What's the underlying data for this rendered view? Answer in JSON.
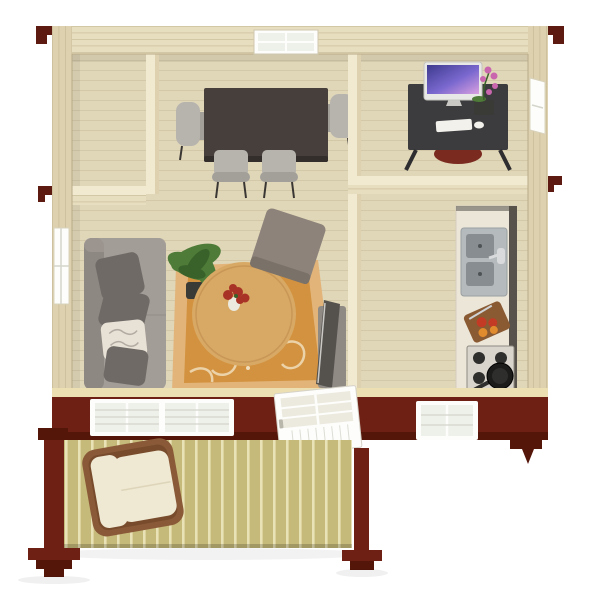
{
  "scene": {
    "description": "isometric-3d-floorplan-render-of-log-cabin",
    "background": "#ffffff",
    "rooms": [
      {
        "name": "entry-room",
        "contents": []
      },
      {
        "name": "dining-room",
        "contents": [
          "dark-dining-table",
          "four-gray-chairs",
          "window"
        ]
      },
      {
        "name": "office",
        "contents": [
          "dark-desk",
          "imac-monitor",
          "keyboard",
          "mouse",
          "orchid-plant",
          "red-chair",
          "side-window"
        ]
      },
      {
        "name": "living-room",
        "contents": [
          "gray-sofa",
          "pillows",
          "potted-plant",
          "round-coffee-table",
          "flower-vase",
          "floral-rug",
          "ottoman",
          "tv"
        ]
      },
      {
        "name": "kitchen",
        "contents": [
          "counter",
          "double-sink",
          "cutting-board-with-fruit",
          "gas-stove",
          "frying-pan"
        ]
      },
      {
        "name": "front-porch",
        "contents": [
          "wicker-armchair",
          "deck-boards",
          "red-posts"
        ]
      }
    ],
    "exterior": [
      "pale-log-walls",
      "maroon-front-wall",
      "double-window",
      "open-white-door",
      "right-window",
      "red-eave-brackets"
    ]
  },
  "palette": {
    "wall_wood": "#e7ddbf",
    "wall_wood_dark": "#ddd1b0",
    "wall_edge": "#b9ac87",
    "wall_line": "#c2b58e",
    "partition_top": "#f1e9d0",
    "floor_wood": "#e0d6b8",
    "floor_line": "#c9bc98",
    "maroon_wall": "#6e2014",
    "maroon_dark": "#55160a",
    "deck_board": "#c6ba7a",
    "deck_gap": "#e9e2b6",
    "rug_main": "#d3923f",
    "rug_border": "#e2b479",
    "rug_swirl": "#f0debc",
    "sofa_gray": "#a39d97",
    "sofa_shade": "#8e8882",
    "pillow_dark": "#6f6a66",
    "pillow_light": "#e8e2d6",
    "table_oak": "#d8a964",
    "table_oak_edge": "#b9854a",
    "vase_white": "#eceadf",
    "flower_red": "#a83226",
    "plant_green": "#4e7c38",
    "plant_green_dark": "#39612a",
    "pot_dark": "#3a3a36",
    "dining_table": "#463f3c",
    "dining_table_edge": "#332e2c",
    "chair_gray": "#b7b4ae",
    "chair_gray_dark": "#a2a099",
    "chair_leg": "#3a3633",
    "desk_dark": "#3c3b3d",
    "desk_leg": "#2e2d2f",
    "office_chair_red": "#7b2a1f",
    "screen_dark": "#3d3a8e",
    "screen_purple": "#7a68cf",
    "screen_pink": "#d9a0e0",
    "device_white": "#f2f1ec",
    "orchid_pink": "#c966ad",
    "counter_cream": "#ece6d8",
    "counter_edge": "#57524b",
    "sink_steel": "#b5babd",
    "basin_dark": "#878d90",
    "faucet_steel": "#d8dadb",
    "board_brown": "#8a5a33",
    "board_brown_edge": "#6d4626",
    "tomato_red": "#c33a25",
    "orange_fruit": "#e08b2d",
    "stove_frame": "#d9d5cd",
    "burner_dark": "#2f2f2d",
    "pan_black": "#1c1c1a",
    "ottoman_gray": "#8d837a",
    "ottoman_shade": "#7a7168",
    "tv_dark": "#55514d",
    "tv_base": "#8f8a84",
    "window_white": "#fdfdfb",
    "window_pane": "#eef0ea",
    "window_mullion": "#d4d6cc",
    "door_panel": "#eceadf",
    "wicker_brown": "#8a5a38",
    "wicker_brown_dark": "#774b2c",
    "cushion_cream": "#efe8d2",
    "cap_cream": "#ecdfb2",
    "eave_red": "#5d1a10",
    "shadow": "#000000"
  }
}
